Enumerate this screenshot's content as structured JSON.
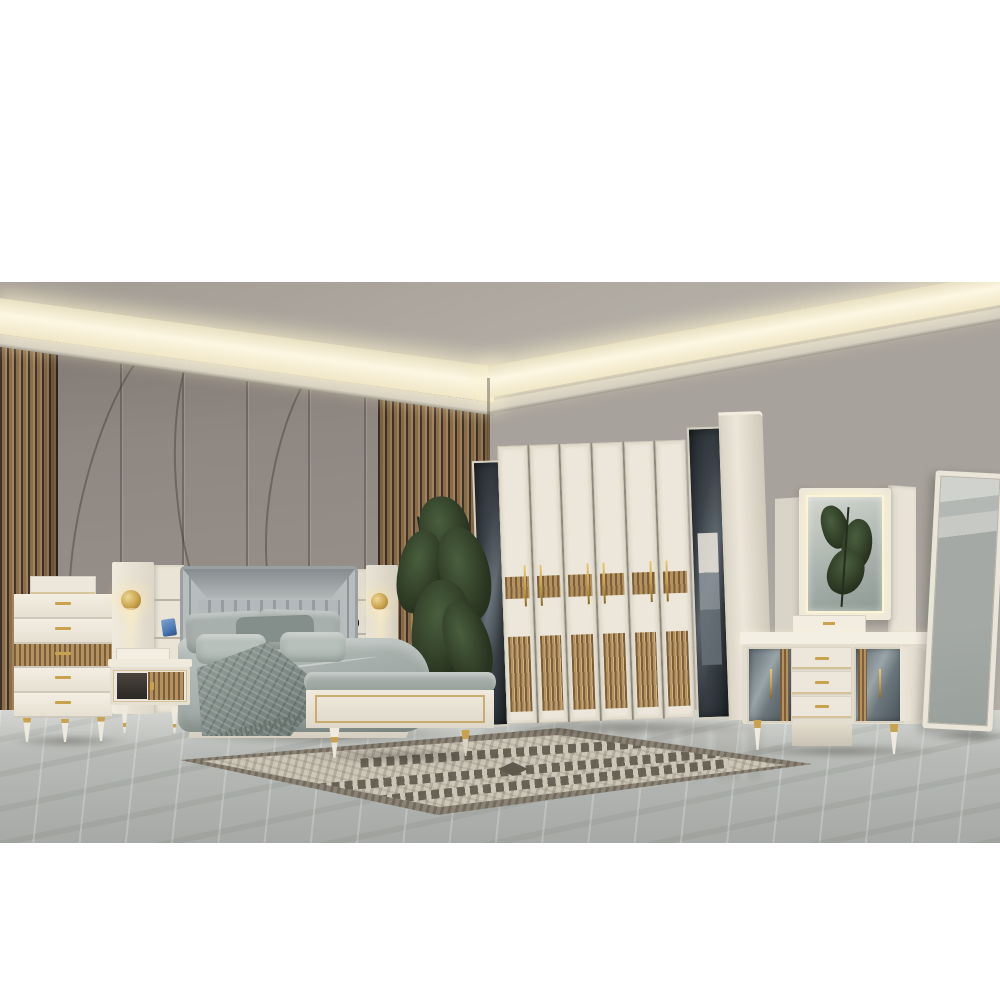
{
  "image_type": "photograph",
  "scene": {
    "description": "Showroom photograph of a modern cream, gold and walnut bedroom furniture set in a grey room with LED cove ceiling lighting, letterboxed on white",
    "text_content": "none — no visible text in image",
    "objects": [
      {
        "name": "ceiling-cove-light",
        "description": "recessed ceiling with warm LED cove strip running around the room corner"
      },
      {
        "name": "wood-slat-wall-panels",
        "description": "vertical walnut slat strips flanking a grey sculpted feature wall"
      },
      {
        "name": "feature-wall",
        "description": "grey wall panels with curved groove relief behind the bed"
      },
      {
        "name": "chest-of-drawers",
        "description": "cream 5-drawer chest, middle drawer walnut slatted, gold handles, gold-tipped legs, storage box on top"
      },
      {
        "name": "bed-tower-left",
        "description": "cream pier with round gold sconce and open shelf unit holding a blue decor object"
      },
      {
        "name": "headboard",
        "description": "light grey channel-tufted upholstered headboard with framed border"
      },
      {
        "name": "bed",
        "description": "grey-green duvet, grey pillows, textured fringed throw blanket, cream platform base"
      },
      {
        "name": "bed-tower-right",
        "description": "cream pier with gold sconce, shelf unit with black alarm clock"
      },
      {
        "name": "nightstand",
        "description": "cream nightstand with open niche, walnut slat sliding door, gold trim and legs"
      },
      {
        "name": "bench",
        "description": "cream foot-of-bed bench, grey cushion, gold rectangle trim, gold tapered legs"
      },
      {
        "name": "wardrobe",
        "description": "eight-door wardrobe: two smoked-mirror doors flanking six cream doors with walnut mid-band, gold handles and walnut slatted lower panels"
      },
      {
        "name": "potted-plant",
        "description": "tall dark green leafy plant between bed and wardrobe"
      },
      {
        "name": "dresser",
        "description": "cream dresser with three gold-trimmed drawers, mirrored side doors with walnut strips, gold spindle legs, tray on top"
      },
      {
        "name": "dresser-mirror",
        "description": "LED edge-lit vanity mirror reflecting a palm plant"
      },
      {
        "name": "standing-mirror",
        "description": "cream framed full-length floor mirror leaning on right wall"
      },
      {
        "name": "area-rug",
        "description": "grey and cream kilim-style rug with dark zigzag bands on marble floor"
      },
      {
        "name": "marble-floor",
        "description": "polished light grey marble floor with white veining and soft reflections"
      }
    ],
    "counts": {
      "wardrobe_cream_doors": 6,
      "wardrobe_mirror_doors": 2,
      "chest_drawers": 5,
      "dresser_drawers": 3,
      "wall_sconces": 2
    }
  },
  "palette": {
    "letterbox": "#ffffff",
    "ceiling": "#b6b1a9",
    "ceiling-dark": "#a49e96",
    "cove-core": "#fdf7e2",
    "ledge": "#ccc7bf",
    "wall-right": "#a7a29b",
    "wall-right-light": "#b6b1aa",
    "wall-panel": "#8f8781",
    "wall-panel-dark": "#7a726c",
    "wall-panel-light": "#9b938d",
    "slat-wood": "#8a6d4b",
    "slat-light": "#a2835a",
    "slat-gap": "#41332a",
    "cream": "#ece7da",
    "wood": "#b3925f",
    "wood-dark": "#7c5f3a",
    "gold": "#c9a24f",
    "headboard": "#b7bcbd",
    "pillow": "#a7b0ac",
    "pillow-dark": "#848e8a",
    "pillow-light": "#b7c0bb",
    "bedding": "#a6afab",
    "bedding-light": "#bcc5c1",
    "bedding-dark": "#8e9894",
    "blanket": "#7e8a85",
    "blanket-light": "#95a09b",
    "bench-cushion": "#aeb6b2",
    "plant": "#28331f",
    "plant-light": "#4a5f3e",
    "floor": "#b7bab6",
    "floor-far": "#c6c8c4",
    "floor-near": "#a6a9a5",
    "rug-field": "#cdc7b8",
    "rug-border": "#8a8274",
    "rug-dark": "#5f584c",
    "decor-blue": "#4a7ab5",
    "clock": "#1d1d1f"
  }
}
